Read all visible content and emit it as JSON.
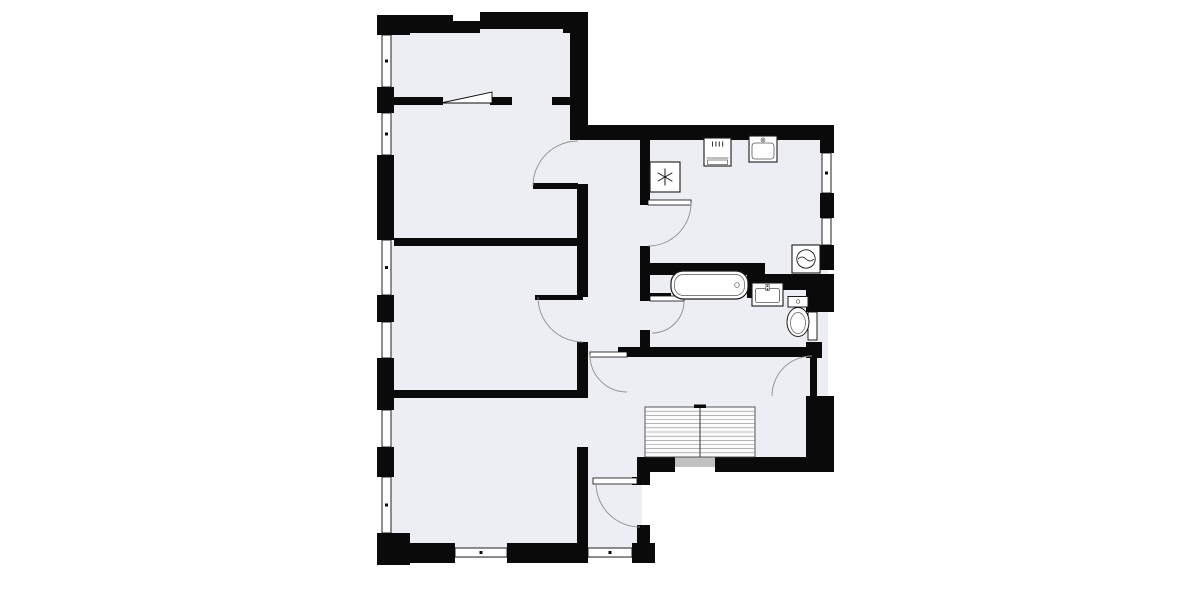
{
  "floorplan": {
    "title": "apartment-floor-plan",
    "colors": {
      "background": "#ffffff",
      "room_fill": "#edeef3",
      "wall": "#0a0a0a",
      "arc": "#8f8f8f",
      "fixture_stroke": "#1a1a1a",
      "fixture_detail": "#555555",
      "stair_line": "#8a8a8a",
      "stair_fill": "#fbfbfc",
      "threshold": "#c2c2c2",
      "window_fill": "#ffffff"
    },
    "fills": [
      {
        "x": 382,
        "y": 22,
        "w": 204,
        "h": 536
      },
      {
        "x": 586,
        "y": 128,
        "w": 242,
        "h": 337
      },
      {
        "x": 584,
        "y": 440,
        "w": 58,
        "h": 118
      }
    ],
    "walls": [
      {
        "x": 377,
        "y": 15,
        "w": 76,
        "h": 18
      },
      {
        "x": 453,
        "y": 21,
        "w": 27,
        "h": 12
      },
      {
        "x": 480,
        "y": 12,
        "w": 83,
        "h": 17
      },
      {
        "x": 563,
        "y": 12,
        "w": 25,
        "h": 21
      },
      {
        "x": 570,
        "y": 15,
        "w": 18,
        "h": 125
      },
      {
        "x": 377,
        "y": 15,
        "w": 33,
        "h": 20
      },
      {
        "x": 377,
        "y": 87,
        "w": 17,
        "h": 26
      },
      {
        "x": 377,
        "y": 155,
        "w": 17,
        "h": 85
      },
      {
        "x": 377,
        "y": 295,
        "w": 17,
        "h": 27
      },
      {
        "x": 377,
        "y": 358,
        "w": 17,
        "h": 52
      },
      {
        "x": 377,
        "y": 447,
        "w": 17,
        "h": 30
      },
      {
        "x": 377,
        "y": 533,
        "w": 33,
        "h": 32
      },
      {
        "x": 377,
        "y": 543,
        "w": 78,
        "h": 20
      },
      {
        "x": 507,
        "y": 543,
        "w": 81,
        "h": 20
      },
      {
        "x": 632,
        "y": 543,
        "w": 23,
        "h": 20
      },
      {
        "x": 388,
        "y": 97,
        "w": 55,
        "h": 8
      },
      {
        "x": 490,
        "y": 97,
        "w": 22,
        "h": 8
      },
      {
        "x": 552,
        "y": 97,
        "w": 18,
        "h": 8
      },
      {
        "x": 394,
        "y": 238,
        "w": 193,
        "h": 8
      },
      {
        "x": 394,
        "y": 390,
        "w": 194,
        "h": 8
      },
      {
        "x": 577,
        "y": 184,
        "w": 11,
        "h": 113
      },
      {
        "x": 577,
        "y": 342,
        "w": 11,
        "h": 56
      },
      {
        "x": 577,
        "y": 447,
        "w": 11,
        "h": 106
      },
      {
        "x": 588,
        "y": 125,
        "w": 246,
        "h": 15
      },
      {
        "x": 820,
        "y": 125,
        "w": 14,
        "h": 28
      },
      {
        "x": 820,
        "y": 193,
        "w": 14,
        "h": 25
      },
      {
        "x": 820,
        "y": 245,
        "w": 14,
        "h": 25
      },
      {
        "x": 747,
        "y": 263,
        "w": 18,
        "h": 35
      },
      {
        "x": 765,
        "y": 274,
        "w": 69,
        "h": 16
      },
      {
        "x": 806,
        "y": 288,
        "w": 28,
        "h": 24
      },
      {
        "x": 806,
        "y": 342,
        "w": 16,
        "h": 16
      },
      {
        "x": 806,
        "y": 396,
        "w": 28,
        "h": 76
      },
      {
        "x": 640,
        "y": 140,
        "w": 10,
        "h": 65
      },
      {
        "x": 640,
        "y": 246,
        "w": 10,
        "h": 55
      },
      {
        "x": 640,
        "y": 330,
        "w": 10,
        "h": 27
      },
      {
        "x": 648,
        "y": 263,
        "w": 99,
        "h": 12
      },
      {
        "x": 648,
        "y": 293,
        "w": 23,
        "h": 8
      },
      {
        "x": 618,
        "y": 347,
        "w": 190,
        "h": 10
      },
      {
        "x": 638,
        "y": 457,
        "w": 37,
        "h": 15
      },
      {
        "x": 715,
        "y": 457,
        "w": 97,
        "h": 15
      },
      {
        "x": 632,
        "y": 477,
        "w": 18,
        "h": 8
      },
      {
        "x": 637,
        "y": 457,
        "w": 13,
        "h": 28
      },
      {
        "x": 637,
        "y": 525,
        "w": 13,
        "h": 38
      }
    ],
    "windows": [
      {
        "x": 382,
        "y": 35,
        "w": 9,
        "h": 52
      },
      {
        "x": 382,
        "y": 113,
        "w": 9,
        "h": 42
      },
      {
        "x": 382,
        "y": 240,
        "w": 9,
        "h": 55
      },
      {
        "x": 382,
        "y": 322,
        "w": 9,
        "h": 36
      },
      {
        "x": 382,
        "y": 410,
        "w": 9,
        "h": 37
      },
      {
        "x": 382,
        "y": 477,
        "w": 9,
        "h": 56
      },
      {
        "x": 822,
        "y": 153,
        "w": 9,
        "h": 40
      },
      {
        "x": 822,
        "y": 218,
        "w": 9,
        "h": 27
      },
      {
        "x": 808,
        "y": 312,
        "w": 9,
        "h": 28
      },
      {
        "x": 455,
        "y": 548,
        "w": 52,
        "h": 9
      },
      {
        "x": 588,
        "y": 548,
        "w": 44,
        "h": 9
      }
    ],
    "thresholds": [
      {
        "x": 675,
        "y": 457,
        "w": 40,
        "h": 10
      }
    ],
    "panels": [
      {
        "points": "441,103 492,92 492,103"
      }
    ],
    "door_leaves": [
      {
        "x": 533,
        "y": 183,
        "w": 45,
        "h": 6,
        "style": "solid"
      },
      {
        "x": 535,
        "y": 295,
        "w": 48,
        "h": 5,
        "style": "solid"
      },
      {
        "x": 810,
        "y": 356,
        "w": 7,
        "h": 40,
        "style": "solid"
      },
      {
        "x": 648,
        "y": 200,
        "w": 43,
        "h": 5,
        "style": "outlined"
      },
      {
        "x": 650,
        "y": 296,
        "w": 34,
        "h": 5,
        "style": "outlined"
      },
      {
        "x": 590,
        "y": 352,
        "w": 37,
        "h": 5,
        "style": "outlined"
      },
      {
        "x": 593,
        "y": 478,
        "w": 44,
        "h": 6,
        "style": "outlined"
      }
    ],
    "door_arcs": [
      {
        "d": "M533,186 A45,45 0 0 1 578,141"
      },
      {
        "d": "M538,297 A45,45 0 0 0 583,342"
      },
      {
        "d": "M691,203 A43,43 0 0 1 648,246"
      },
      {
        "d": "M684,301 A32,32 0 0 1 652,333"
      },
      {
        "d": "M590,355 A37,37 0 0 0 627,392"
      },
      {
        "d": "M812,356 A40,40 0 0 0 772,396"
      },
      {
        "d": "M596,483 A44,44 0 0 0 640,527"
      },
      {
        "d": "M676,456 Q702,445 729,456"
      }
    ],
    "fixtures": [
      {
        "type": "refrigerator",
        "x": 650,
        "y": 162,
        "w": 30,
        "h": 30
      },
      {
        "type": "stove",
        "x": 704,
        "y": 138,
        "w": 27,
        "h": 28
      },
      {
        "type": "kitchen-sink",
        "x": 749,
        "y": 136,
        "w": 28,
        "h": 26
      },
      {
        "type": "washing-machine",
        "x": 792,
        "y": 245,
        "w": 28,
        "h": 28
      },
      {
        "type": "bathtub",
        "x": 671,
        "y": 271,
        "w": 77,
        "h": 28
      },
      {
        "type": "bathroom-sink",
        "x": 752,
        "y": 283,
        "w": 31,
        "h": 23
      },
      {
        "type": "toilet",
        "x": 787,
        "y": 296,
        "w": 22,
        "h": 42
      },
      {
        "type": "staircase",
        "x": 645,
        "y": 407,
        "w": 110,
        "h": 50,
        "treads": 12
      }
    ]
  }
}
